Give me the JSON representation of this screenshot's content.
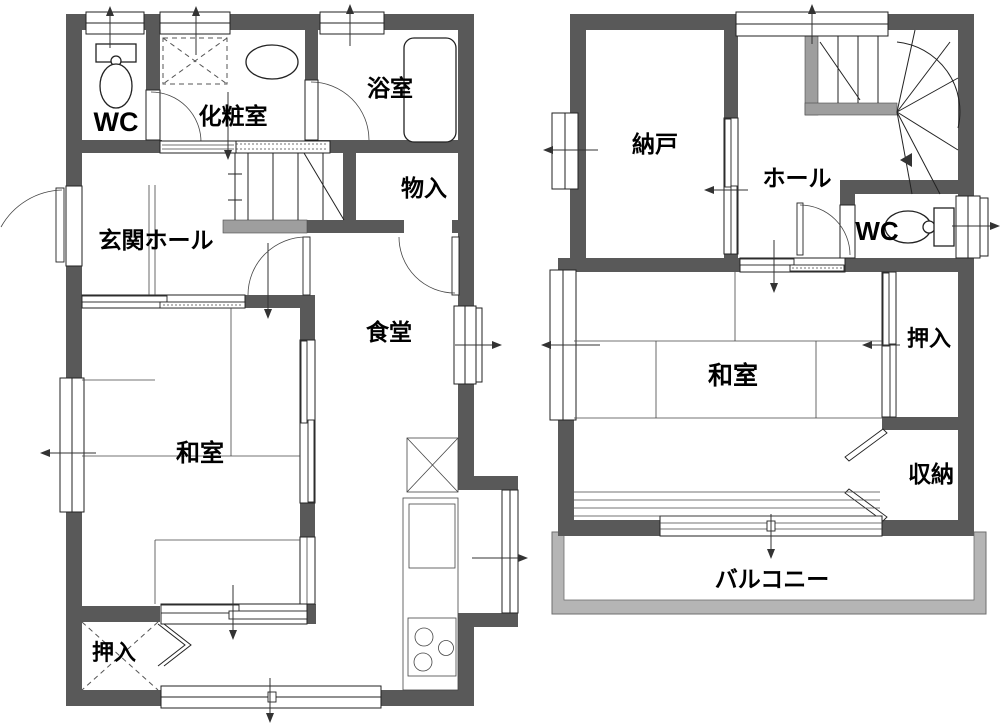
{
  "document": {
    "type": "floor-plan",
    "background": "#ffffff"
  },
  "colors": {
    "wall": "#595959",
    "stair_wall": "#9e9e9e",
    "balcony_frame": "#b5b5b5",
    "line": "#222222",
    "text": "#000000"
  },
  "floor1": {
    "rooms": {
      "wc": "WC",
      "powder_room": "化粧室",
      "bathroom": "浴室",
      "storage": "物入",
      "entrance_hall": "玄関ホール",
      "dining": "食堂",
      "japanese_room": "和室",
      "closet": "押入"
    }
  },
  "floor2": {
    "rooms": {
      "storeroom": "納戸",
      "hall": "ホール",
      "wc": "WC",
      "closet": "押入",
      "japanese_room": "和室",
      "storage": "収納",
      "balcony": "バルコニー"
    }
  }
}
